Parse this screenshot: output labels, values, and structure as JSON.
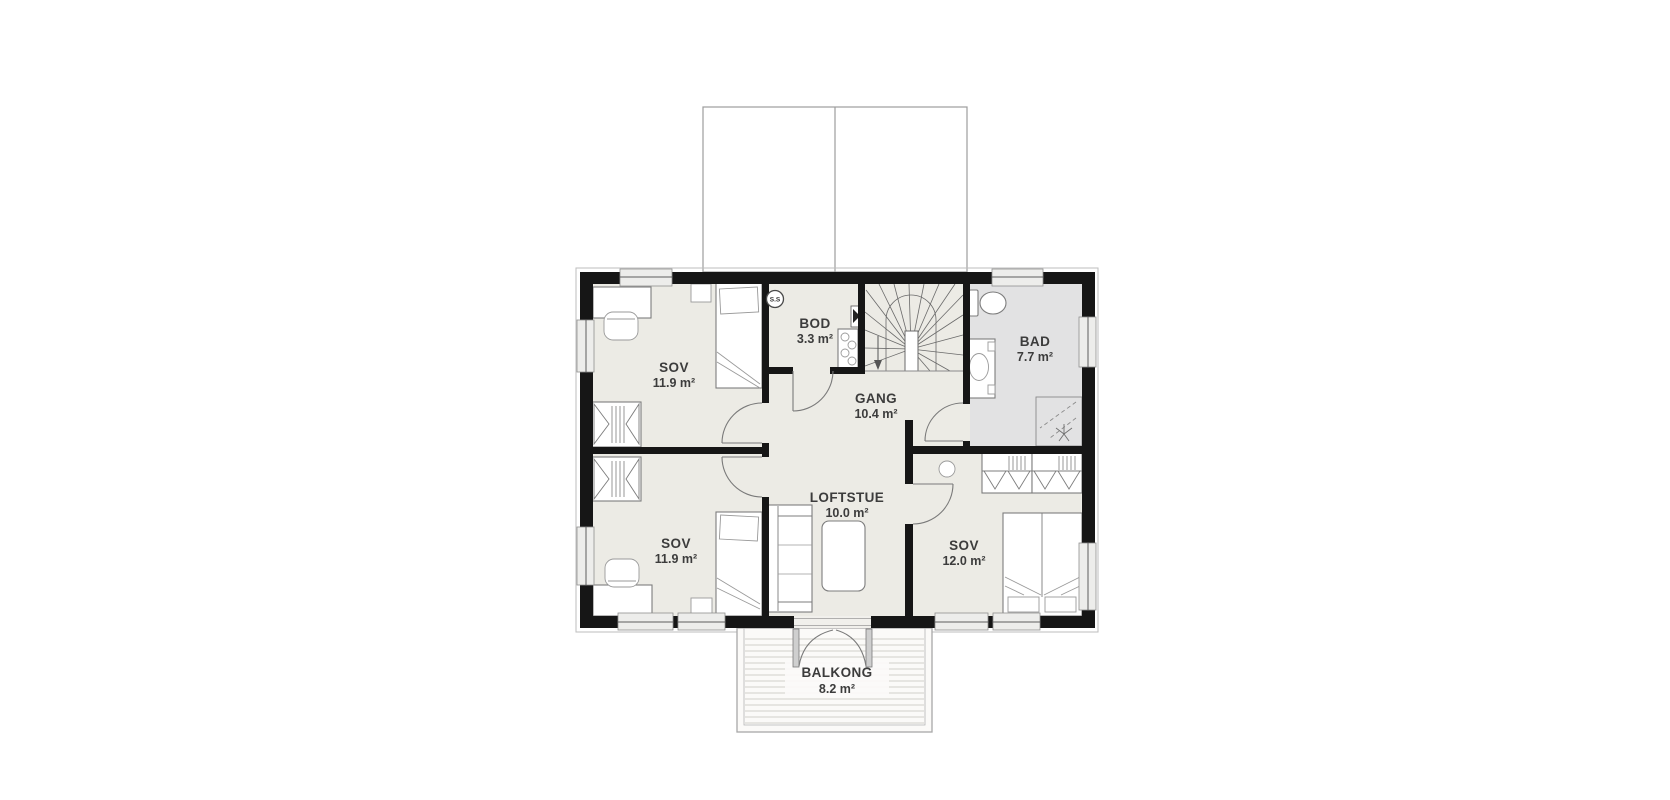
{
  "plan": {
    "rooms": {
      "sov_top_left": {
        "name": "SOV",
        "area": "11.9 m²"
      },
      "bod": {
        "name": "BOD",
        "area": "3.3 m²"
      },
      "bad": {
        "name": "BAD",
        "area": "7.7 m²"
      },
      "gang": {
        "name": "GANG",
        "area": "10.4 m²"
      },
      "sov_bottom_left": {
        "name": "SOV",
        "area": "11.9 m²"
      },
      "loftstue": {
        "name": "LOFTSTUE",
        "area": "10.0 m²"
      },
      "sov_bottom_right": {
        "name": "SOV",
        "area": "12.0 m²"
      },
      "balkong": {
        "name": "BALKONG",
        "area": "8.2 m²"
      }
    },
    "labels": {
      "stair_shaft": "S.S"
    },
    "colors": {
      "floor": "#ECEBE5",
      "bathroom_floor": "#E2E2E3",
      "wall": "#161616",
      "background": "#FFFFFF"
    }
  }
}
